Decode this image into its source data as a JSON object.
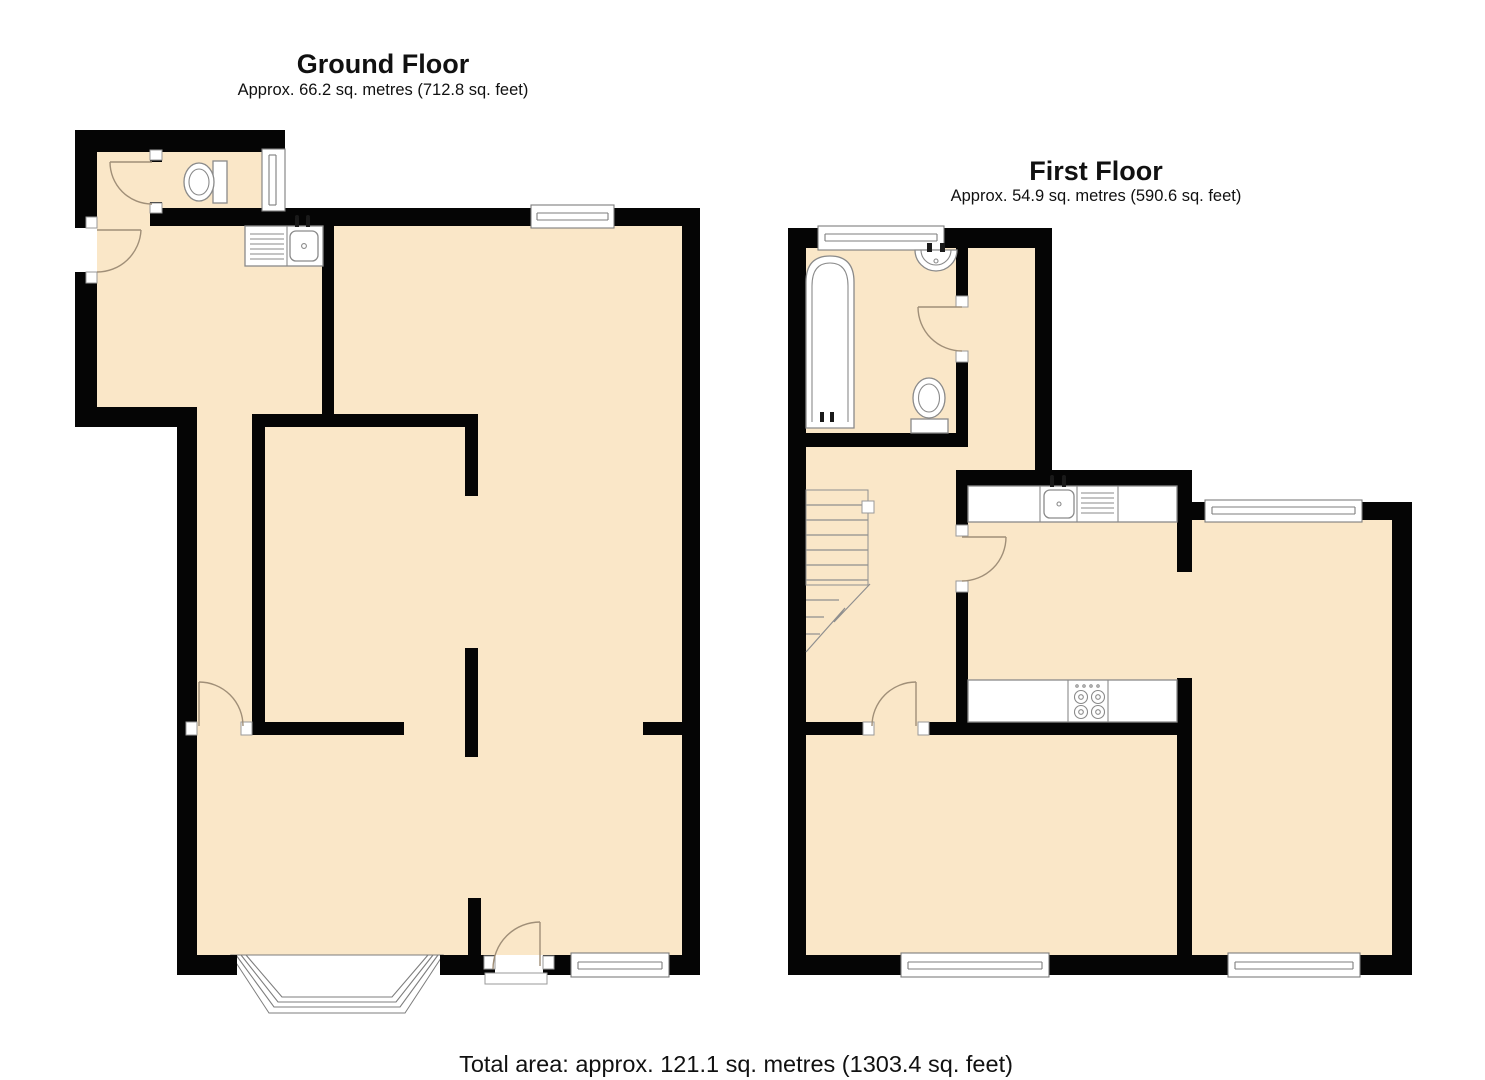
{
  "ground_floor": {
    "title": "Ground Floor",
    "subtitle": "Approx. 66.2 sq. metres (712.8 sq. feet)",
    "area_sq_metres": 66.2,
    "area_sq_feet": 712.8
  },
  "first_floor": {
    "title": "First Floor",
    "subtitle": "Approx. 54.9 sq. metres (590.6 sq. feet)",
    "area_sq_metres": 54.9,
    "area_sq_feet": 590.6
  },
  "footer": {
    "total_area_label": "Total area: approx. 121.1 sq. metres (1303.4 sq. feet)",
    "total_sq_metres": 121.1,
    "total_sq_feet": 1303.4
  },
  "colors": {
    "wall": "#050505",
    "floor_fill": "#fae7c8",
    "background": "#ffffff",
    "fixture_outline": "#8a8a8a",
    "door_arc": "#a08f78"
  },
  "fixtures": {
    "ground_floor": [
      "toilet-symbol",
      "kitchen-sink-symbol",
      "bay-window",
      "entrance-door",
      "rear-door",
      "windows"
    ],
    "first_floor": [
      "bathtub-symbol",
      "basin-symbol",
      "toilet-symbol",
      "staircase-symbol",
      "kitchen-sink-symbol",
      "stove-hob-symbol",
      "windows"
    ]
  }
}
